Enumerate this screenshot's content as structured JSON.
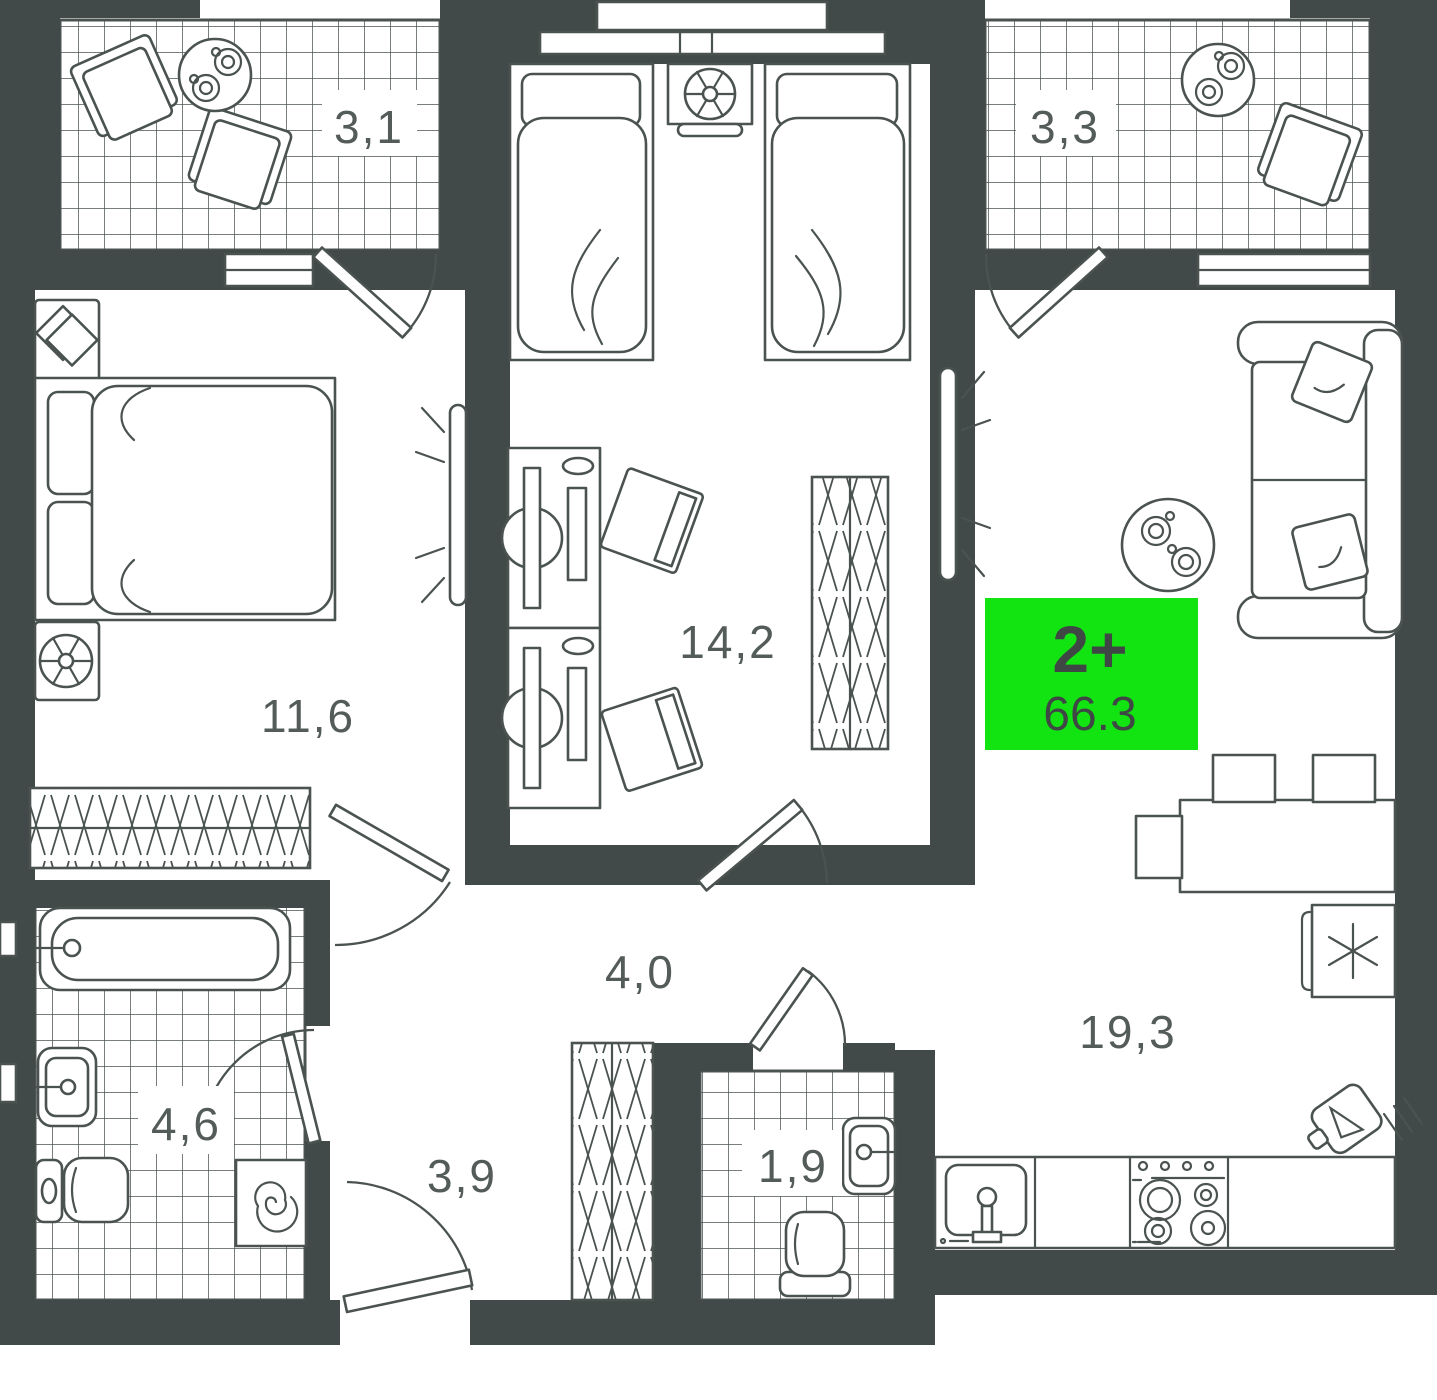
{
  "floorplan": {
    "apartment": {
      "type": "2+",
      "area": "66.3"
    },
    "rooms": [
      {
        "id": "balcony-left",
        "label": "3,1"
      },
      {
        "id": "balcony-right",
        "label": "3,3"
      },
      {
        "id": "bedroom",
        "label": "11,6"
      },
      {
        "id": "second-room",
        "label": "14,2"
      },
      {
        "id": "hallway",
        "label": "4,0"
      },
      {
        "id": "bathroom",
        "label": "4,6"
      },
      {
        "id": "corridor",
        "label": "3,9"
      },
      {
        "id": "wc",
        "label": "1,9"
      },
      {
        "id": "kitchen-living",
        "label": "19,3"
      }
    ],
    "colors": {
      "wall": "#414a48",
      "line": "#4b5351",
      "label": "#545c59",
      "green": "#12e412",
      "badge_text": "#3f4745",
      "bg": "#ffffff"
    }
  }
}
